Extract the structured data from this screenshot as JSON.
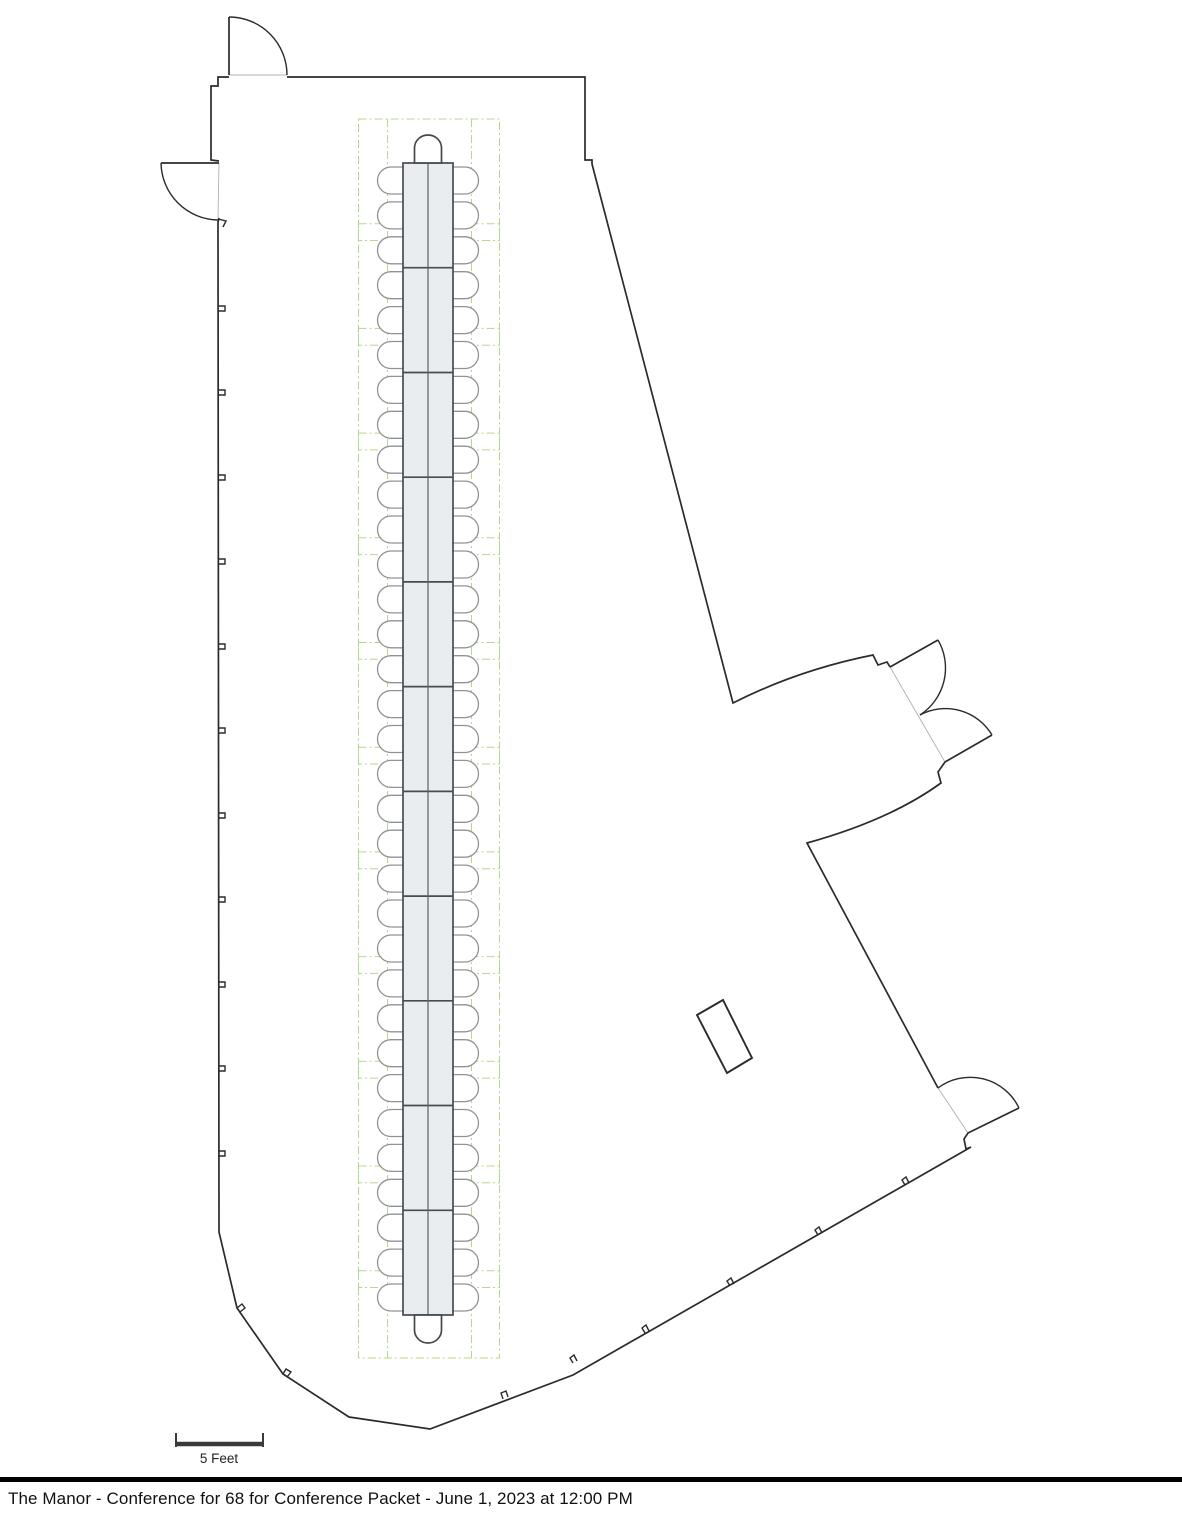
{
  "footer": {
    "title": "The Manor - Conference for 68 for Conference Packet - June 1, 2023 at 12:00 PM"
  },
  "scale_bar": {
    "label": "5 Feet",
    "x1": 176,
    "x2": 263,
    "bar_y": 1444,
    "tick_top": 1433,
    "tick_bottom": 1447,
    "label_x": 219,
    "label_y": 1463
  },
  "colors": {
    "wall": "#2b2b2b",
    "opening_line": "#b0b0b0",
    "door": "#2b2b2b",
    "tick": "#2b2b2b",
    "table_fill": "#e9edf0",
    "table_stroke": "#474c52",
    "table_centerline": "#5a6066",
    "chair_stroke": "#909396",
    "chair_fill": "#ffffff",
    "end_chair_stroke": "#45494d",
    "zone_green": "#b6d78a",
    "column_stroke": "#2b2b2b",
    "scale_bar": "#3a3a3a"
  },
  "floorplan": {
    "total_seats": 68,
    "walls": [
      "M287,77 L585,77 L585,160 L592,160 L592,164 L733,703 Q798,670 873,655 L878,665 L887,662 L890,667",
      "M945,762 L938,772 L941,783 Q890,820 807,843 L938,1088",
      "M968,1133 L964,1139 L966,1149 L971,1147 L573,1375 L430,1429 L349,1417 L283,1374 L237,1308 L219,1232 L218,222 L219,218",
      "M219,161 L211,160 L211,86 L218,86 L218,77 L229,77"
    ],
    "openings": [
      "M229,75 L287,75",
      "M219,163 L218,218",
      "M890,667 L945,762",
      "M938,1088 L968,1133"
    ],
    "doors": [
      {
        "leaf": "M229,75 L229,17",
        "arc": "M229,17 A58,58 0 0 1 287,75"
      },
      {
        "leaf": "M219,163 L161,163",
        "arc": "M161,163 A58,58 0 0 0 218,220"
      },
      {
        "leaf": "M890,667 L938,640",
        "arc": "M938,640 A56,56 0 0 1 920,715"
      },
      {
        "leaf": "M945,762 L992,735",
        "arc": "M920,715 A54,54 0 0 1 992,735"
      },
      {
        "leaf": "M968,1133 L1019,1108",
        "arc": "M938,1088 A54,54 0 0 1 1019,1108"
      }
    ],
    "ticks": [
      "M218,306 h7 v5 h-7",
      "M218,390 h7 v5 h-7",
      "M218,475 h7 v5 h-7",
      "M218,559 h7 v5 h-7",
      "M218,644 h7 v5 h-7",
      "M218,728 h7 v5 h-7",
      "M218,813 h7 v5 h-7",
      "M218,897 h7 v5 h-7",
      "M218,982 h7 v5 h-7",
      "M218,1066 h7 v5 h-7",
      "M218,1151 h7 v5 h-7",
      "M218,219 L226,221 L223,227",
      "M237,1308 L242,1304 L245,1308 L240,1312",
      "M283,1374 L286,1369 L291,1372 L287,1377",
      "M905,1185 L902,1180 L906,1177 L909,1183",
      "M818,1235 L815,1230 L819,1227 L822,1233",
      "M730,1286 L727,1281 L731,1278 L734,1284",
      "M645,1333 L642,1328 L646,1325 L649,1331",
      "M573,1363 L570,1358 L574,1355 L577,1361",
      "M503,1399 L501,1393 L506,1391 L508,1397"
    ],
    "column": "M697,1015 L723,1000 L752,1058 L727,1073 Z",
    "zones": {
      "x": 358.5,
      "w": 141,
      "y_top": 119,
      "y_bottom": 1358,
      "pitch": 104.7,
      "box_h": 121.5,
      "inner_x": [
        387.5,
        471.5
      ],
      "dash": "8 3 2 3"
    },
    "table": {
      "x": 403,
      "y": 163,
      "w": 50,
      "h": 1152,
      "segments": 11,
      "side_seats": 33,
      "end_seats": 2,
      "chair": {
        "half_h": 13.5,
        "left_inner_x": 409,
        "left_arc_x": 391,
        "left_outer_r": 13.5,
        "right_inner_x": 447,
        "right_arc_x": 465
      },
      "end_chairs": [
        "M414.5,163 v-15 a13.5,13 0 0 1 13.5,-13 a13.5,13 0 0 1 13.5,13 v15 z",
        "M414.5,1315 v15 a13.5,13 0 0 0 13.5,13 a13.5,13 0 0 0 13.5,-13 v-15 z"
      ]
    }
  }
}
